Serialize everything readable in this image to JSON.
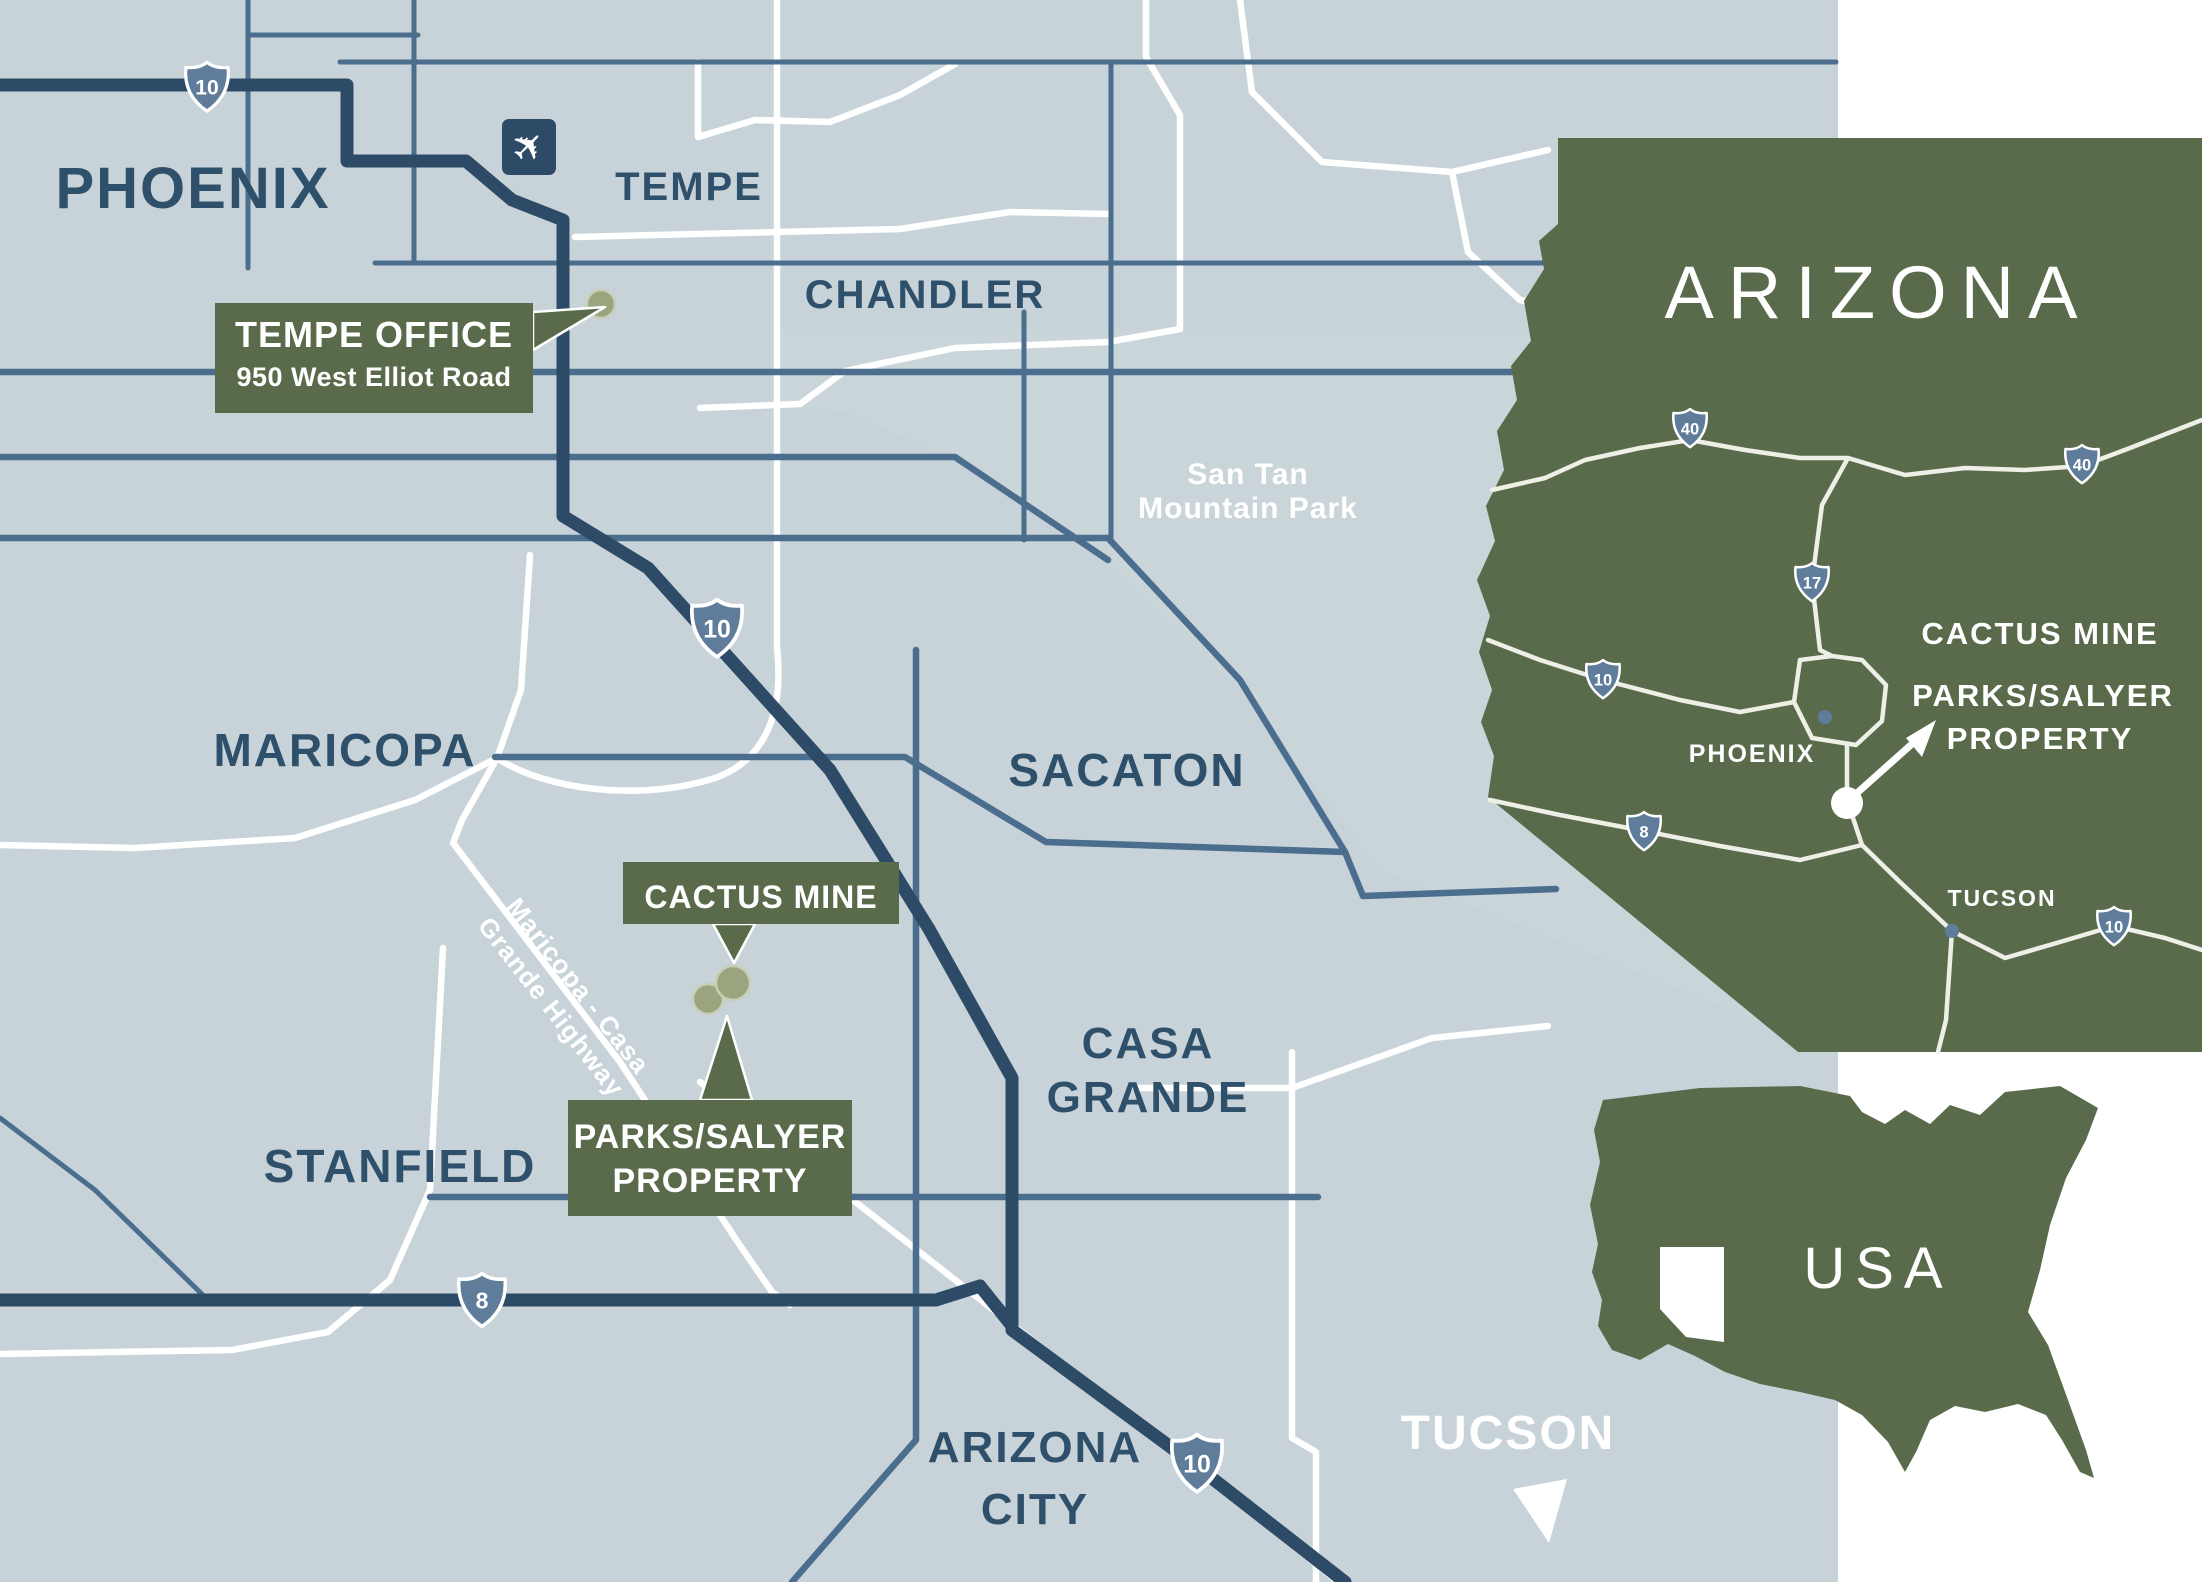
{
  "palette": {
    "map_bg": "#c7d3d8",
    "panel_bg": "#ffffff",
    "tint": "#cdd7db",
    "road_white": "#ffffff",
    "road_med": "#4b6d8e",
    "road_dark": "#2d4b66",
    "green": "#596b4b",
    "dot": "#9aa47e",
    "dot_ring": "#c9cfb6",
    "navy": "#2f506b",
    "shield": "#5f7d9b",
    "inset_road": "#eef0e8"
  },
  "main": {
    "labels": {
      "phoenix": "PHOENIX",
      "tempe": "TEMPE",
      "chandler": "CHANDLER",
      "maricopa": "MARICOPA",
      "sacaton": "SACATON",
      "casa_grande_1": "CASA",
      "casa_grande_2": "GRANDE",
      "stanfield": "STANFIELD",
      "arizona_city_1": "ARIZONA",
      "arizona_city_2": "CITY",
      "tucson": "TUCSON",
      "san_tan_1": "San Tan",
      "san_tan_2": "Mountain Park",
      "mcg_hwy_1": "Maricopa - Casa",
      "mcg_hwy_2": "Grande Highway"
    },
    "callouts": {
      "tempe_office": {
        "title": "TEMPE OFFICE",
        "subtitle": "950 West Elliot Road"
      },
      "cactus_mine": {
        "title": "CACTUS MINE"
      },
      "parks_salyer": {
        "line1": "PARKS/SALYER",
        "line2": "PROPERTY"
      }
    },
    "shields": {
      "i10": "10",
      "i8": "8"
    }
  },
  "az_inset": {
    "title": "ARIZONA",
    "phoenix": "PHOENIX",
    "tucson": "TUCSON",
    "callout_1": "CACTUS MINE",
    "callout_2": "PARKS/SALYER",
    "callout_3": "PROPERTY",
    "shields": {
      "i40": "40",
      "i17": "17",
      "i10": "10",
      "i8": "8"
    }
  },
  "usa_inset": {
    "title": "USA"
  },
  "icons": {
    "airplane": "✈"
  }
}
